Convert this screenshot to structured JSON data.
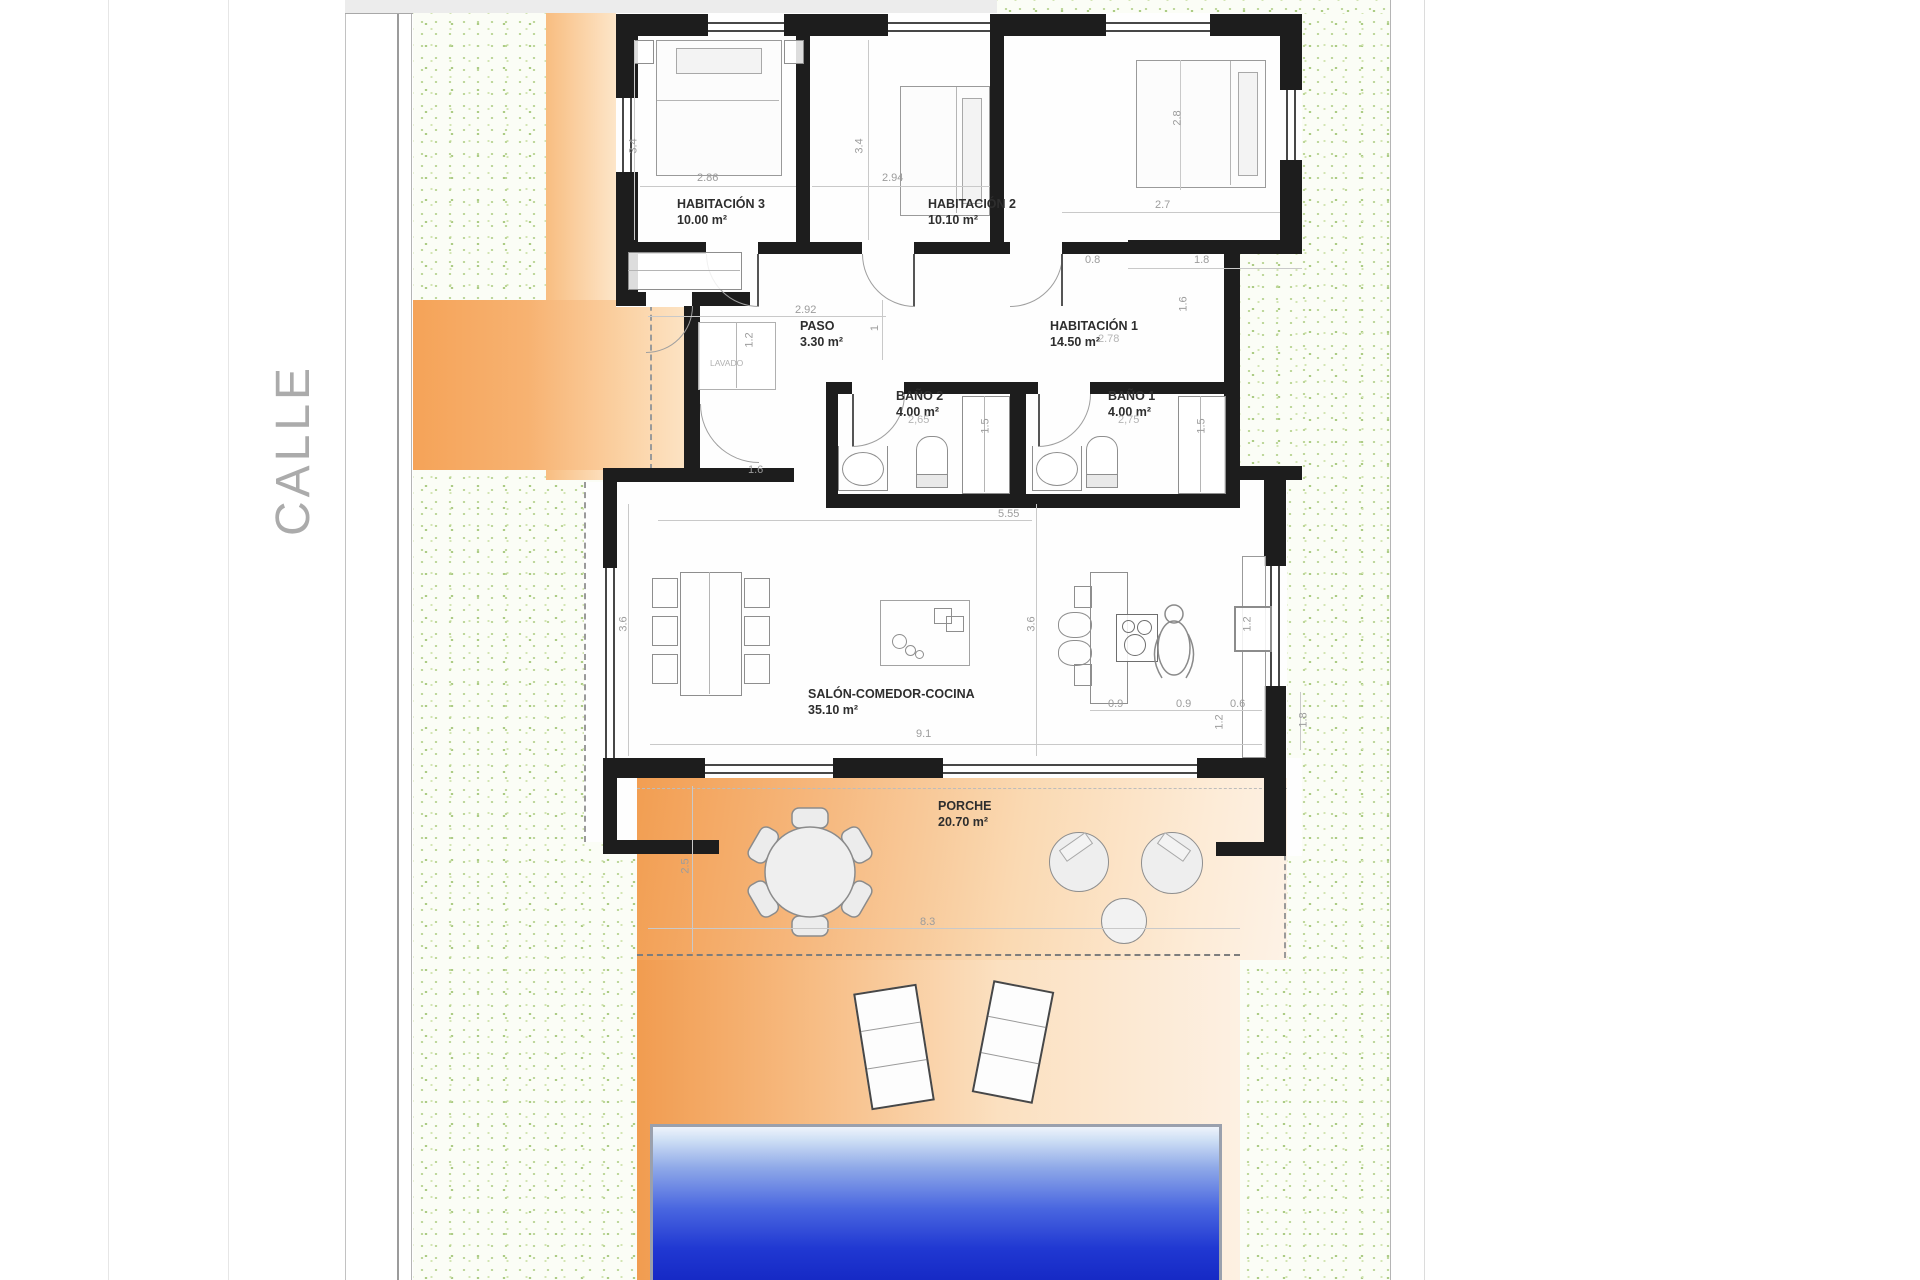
{
  "street": {
    "label": "CALLE"
  },
  "rooms": {
    "hab3": {
      "name": "HABITACIÓN 3",
      "area": "10.00 m²"
    },
    "hab2": {
      "name": "HABITACIÓN 2",
      "area": "10.10 m²"
    },
    "hab1": {
      "name": "HABITACIÓN 1",
      "area": "14.50 m²"
    },
    "paso": {
      "name": "PASO",
      "area": "3.30 m²"
    },
    "bano2": {
      "name": "BAÑO 2",
      "area": "4.00 m²"
    },
    "bano1": {
      "name": "BAÑO 1",
      "area": "4.00 m²"
    },
    "salon": {
      "name": "SALÓN-COMEDOR-COCINA",
      "area": "35.10 m²"
    },
    "porche": {
      "name": "PORCHE",
      "area": "20.70 m²"
    },
    "lavado": {
      "name": "LAVADO"
    }
  },
  "dims": {
    "hab3_h": "3.4",
    "hab3_w": "2.86",
    "hab2_h": "3.4",
    "hab2_w": "2.94",
    "hab1_bed": "2.8",
    "hab1_w": "2.7",
    "hab1_d": "2.78",
    "notch_a": "0.8",
    "notch_b": "1.8",
    "notch_c": "1.6",
    "paso_w": "2.92",
    "paso_r": "1",
    "lavado_w": "1.2",
    "bano2_w": "2,65",
    "bano1_w": "2,75",
    "shower2": "1.5",
    "shower1": "1.5",
    "entry": "1.6",
    "salon_top": "5.55",
    "salon_hl": "3.6",
    "salon_hr": "3.6",
    "salon_w": "9.1",
    "kitchen_a": "0.9",
    "kitchen_b": "0.9",
    "kitchen_c": "0.6",
    "kitchen_d": "1.2",
    "kitchen_box": "1.2",
    "side_e": "1.8",
    "porch_h": "2.5",
    "porch_w": "8.3"
  },
  "colors": {
    "wall": "#1d1d1d",
    "grass_dot": "#b9d492",
    "orange_deep": "#f29e52",
    "orange_pale": "#fdf2e6",
    "pool_deep": "#1628c4",
    "pool_light": "#eef3fb",
    "dim_text": "#9c9c9c",
    "label_text": "#2e2e2e"
  },
  "furniture_icons": [
    "double-bed-icon",
    "nightstand-icon",
    "wardrobe-icon",
    "washer-closet-icon",
    "toilet-icon",
    "sink-icon",
    "shower-icon",
    "door-arc-icon",
    "window-icon",
    "dining-table-icon",
    "chair-icon",
    "coffee-table-icon",
    "kitchen-island-icon",
    "cooktop-icon",
    "bar-stool-icon",
    "person-figure-icon",
    "kitchen-counter-icon",
    "appliance-icon",
    "round-table-icon",
    "lounge-chair-icon",
    "side-table-icon",
    "sun-lounger-icon",
    "swimming-pool"
  ]
}
